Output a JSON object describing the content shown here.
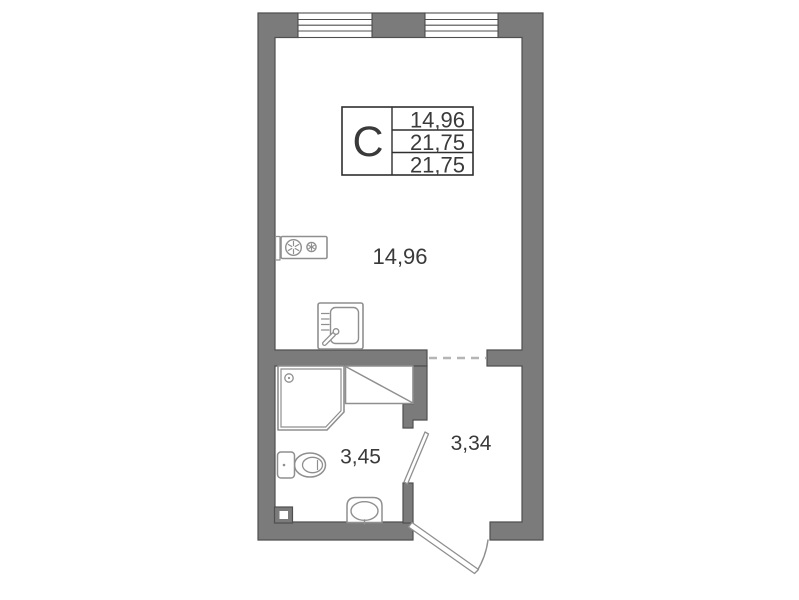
{
  "plan": {
    "title": "studio-floor-plan",
    "info_box": {
      "type_label": "C",
      "rows": [
        "14,96",
        "21,75",
        "21,75"
      ]
    },
    "rooms": {
      "main": {
        "area": "14,96"
      },
      "bathroom": {
        "area": "3,45"
      },
      "hallway": {
        "area": "3,34"
      }
    },
    "colors": {
      "background": "#ffffff",
      "wall_fill": "#7b7b7b",
      "wall_outline": "#4f4f4f",
      "fixture_stroke": "#8f8f8f",
      "dash": "#b5b5b5",
      "text": "#3a3a3a"
    }
  }
}
